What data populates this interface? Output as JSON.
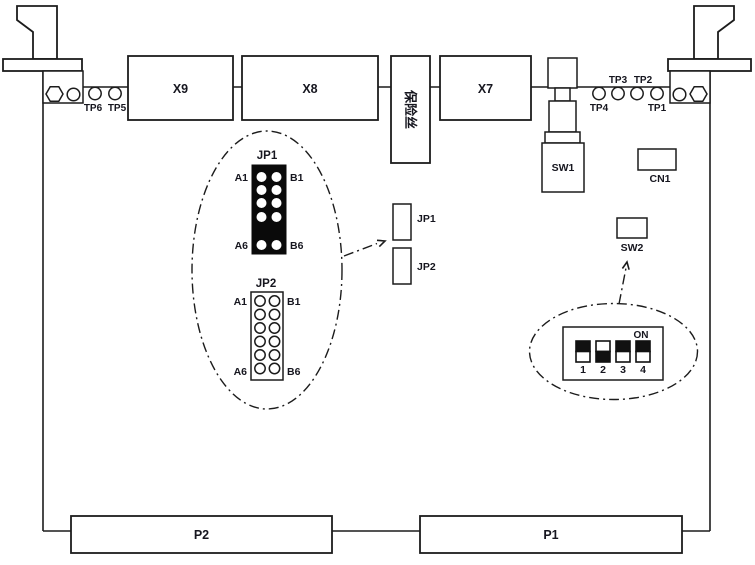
{
  "colors": {
    "background": "#ffffff",
    "line": "#1c1c1c",
    "text": "#16161f",
    "jumper_block": "#0a0a0a",
    "switch_on_fill": "#111111",
    "switch_off_fill": "#ffffff"
  },
  "icons": {
    "hex_nut": "hexagon outline",
    "screw_hole": "circle outline",
    "test_point": "small circle on board edge",
    "ejector_handle": "card ejector lever polygon"
  },
  "board": {
    "connectors": {
      "x9": "X9",
      "x8": "X8",
      "x7": "X7",
      "p1": "P1",
      "p2": "P2",
      "cn1": "CN1"
    },
    "fuse": {
      "label": "保险丝"
    },
    "switches": {
      "sw1": "SW1",
      "sw2": "SW2"
    },
    "test_points": {
      "tp1": "TP1",
      "tp2": "TP2",
      "tp3": "TP3",
      "tp4": "TP4",
      "tp5": "TP5",
      "tp6": "TP6"
    },
    "jumpers": {
      "jp1": "JP1",
      "jp2": "JP2"
    }
  },
  "jp_detail": {
    "jp1": {
      "title": "JP1",
      "top_left": "A1",
      "top_right": "B1",
      "bottom_left": "A6",
      "bottom_right": "B6",
      "style": "black block, 2 columns, pins A1-A6 / B1-B6"
    },
    "jp2": {
      "title": "JP2",
      "top_left": "A1",
      "top_right": "B1",
      "bottom_left": "A6",
      "bottom_right": "B6",
      "style": "outlined block, 2 columns x 6 rows open holes"
    }
  },
  "dip_detail": {
    "on_label": "ON",
    "switches": [
      {
        "label": "1",
        "state": "ON",
        "top_fill": "#111111",
        "bottom_fill": "#ffffff"
      },
      {
        "label": "2",
        "state": "OFF",
        "top_fill": "#ffffff",
        "bottom_fill": "#111111"
      },
      {
        "label": "3",
        "state": "ON",
        "top_fill": "#111111",
        "bottom_fill": "#ffffff"
      },
      {
        "label": "4",
        "state": "ON",
        "top_fill": "#111111",
        "bottom_fill": "#ffffff"
      }
    ]
  }
}
